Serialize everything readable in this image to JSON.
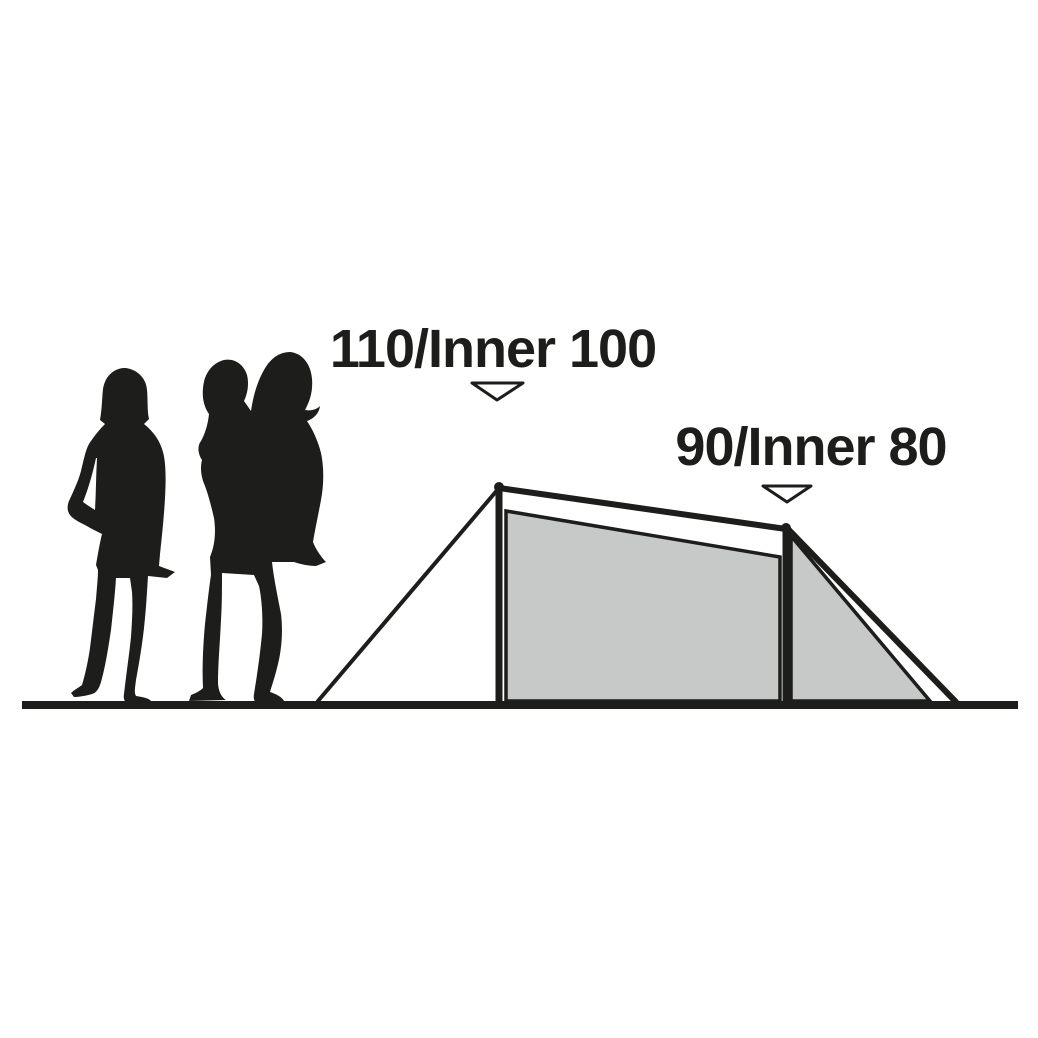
{
  "colors": {
    "background": "#ffffff",
    "ink": "#1d1d1b",
    "tent_fill": "#c7c9c8",
    "marker_fill": "#ffffff"
  },
  "diagram": {
    "description": "Tent side-profile height diagram with human silhouettes for scale",
    "front_measurement": {
      "label": "110/Inner 100",
      "outer_height": "110",
      "inner_height": "100"
    },
    "rear_measurement": {
      "label": "90/Inner 80",
      "outer_height": "90",
      "inner_height": "80"
    },
    "figures": {
      "left_figure": "standing-woman-silhouette",
      "right_figure": "adult-carrying-child-silhouette"
    },
    "icons": {
      "front_marker": "triangle-down-icon",
      "rear_marker": "triangle-down-icon"
    }
  }
}
